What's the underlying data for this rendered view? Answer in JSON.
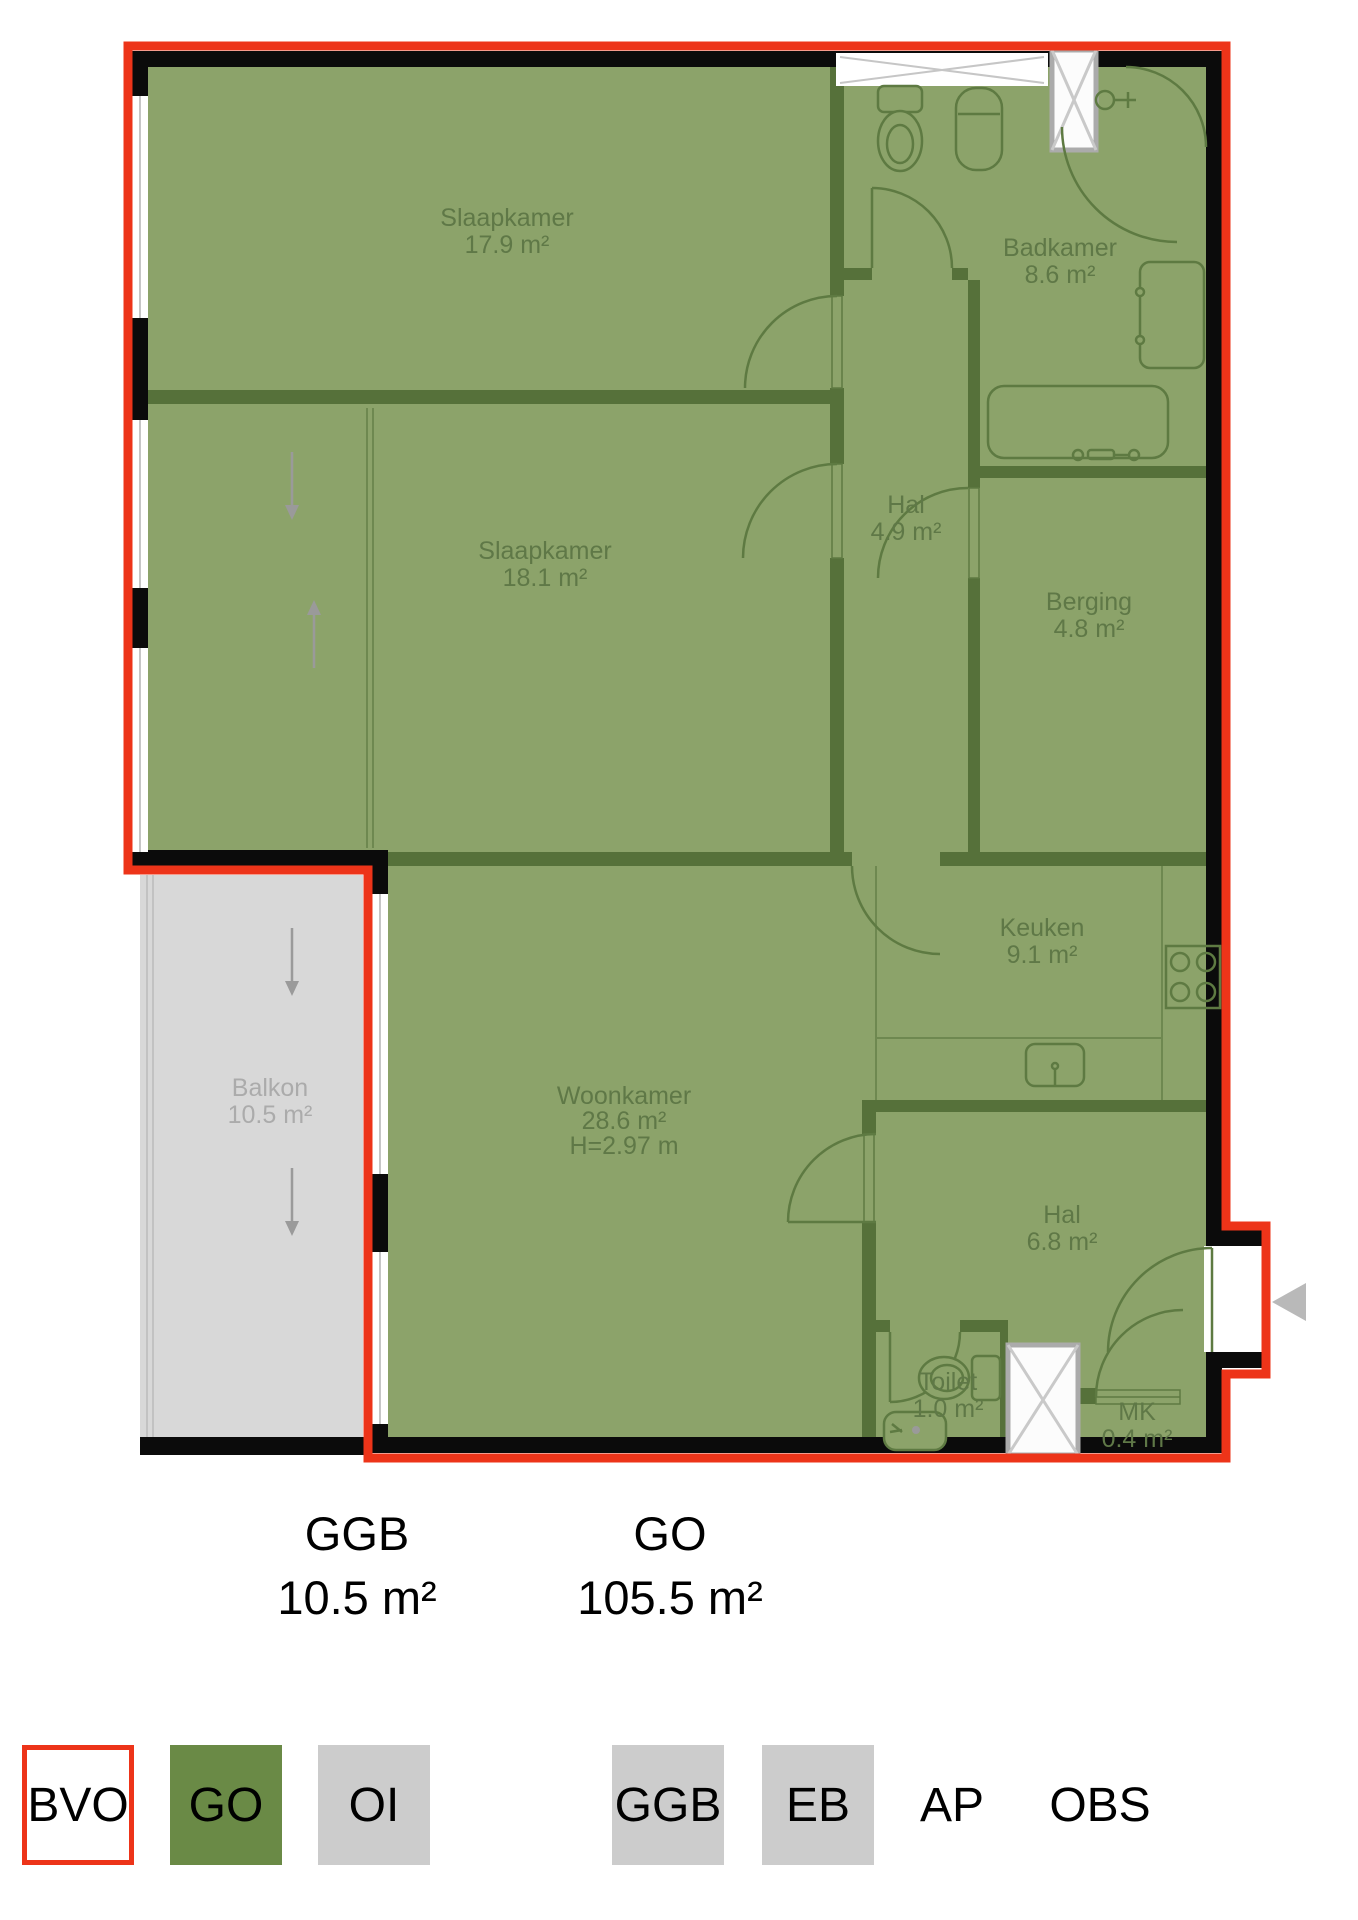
{
  "floorplan": {
    "rooms": [
      {
        "name": "Slaapkamer",
        "area": "17.9 m²"
      },
      {
        "name": "Slaapkamer",
        "area": "18.1 m²"
      },
      {
        "name": "Badkamer",
        "area": "8.6 m²"
      },
      {
        "name": "Hal",
        "area": "4.9 m²"
      },
      {
        "name": "Berging",
        "area": "4.8 m²"
      },
      {
        "name": "Keuken",
        "area": "9.1 m²"
      },
      {
        "name": "Woonkamer",
        "area": "28.6 m²",
        "height": "H=2.97 m"
      },
      {
        "name": "Balkon",
        "area": "10.5 m²"
      },
      {
        "name": "Hal",
        "area": "6.8 m²"
      },
      {
        "name": "Toilet",
        "area": "1.0 m²"
      },
      {
        "name": "MK",
        "area": "0.4 m²"
      }
    ],
    "summary": {
      "ggb": {
        "code": "GGB",
        "area": "10.5 m²"
      },
      "go": {
        "code": "GO",
        "area": "105.5 m²"
      }
    },
    "legend": {
      "items": [
        {
          "label": "BVO",
          "style": "red-outline"
        },
        {
          "label": "GO",
          "style": "green-fill"
        },
        {
          "label": "OI",
          "style": "gray-fill"
        },
        {
          "label": "GGB",
          "style": "gray-fill"
        },
        {
          "label": "EB",
          "style": "gray-fill"
        },
        {
          "label": "AP",
          "style": "text-only"
        },
        {
          "label": "OBS",
          "style": "text-only"
        }
      ]
    },
    "colors": {
      "bvo_red": "#ED3419",
      "go_green": "#8CA36A",
      "wall_black": "#0B0B0B",
      "interior_wall": "#56713A",
      "ggb_gray": "#D8D8D8",
      "legend_green": "#6A8A46",
      "legend_gray": "#CCCCCC",
      "label_green": "#5F7847",
      "balcony_label": "#ABABAB"
    }
  }
}
